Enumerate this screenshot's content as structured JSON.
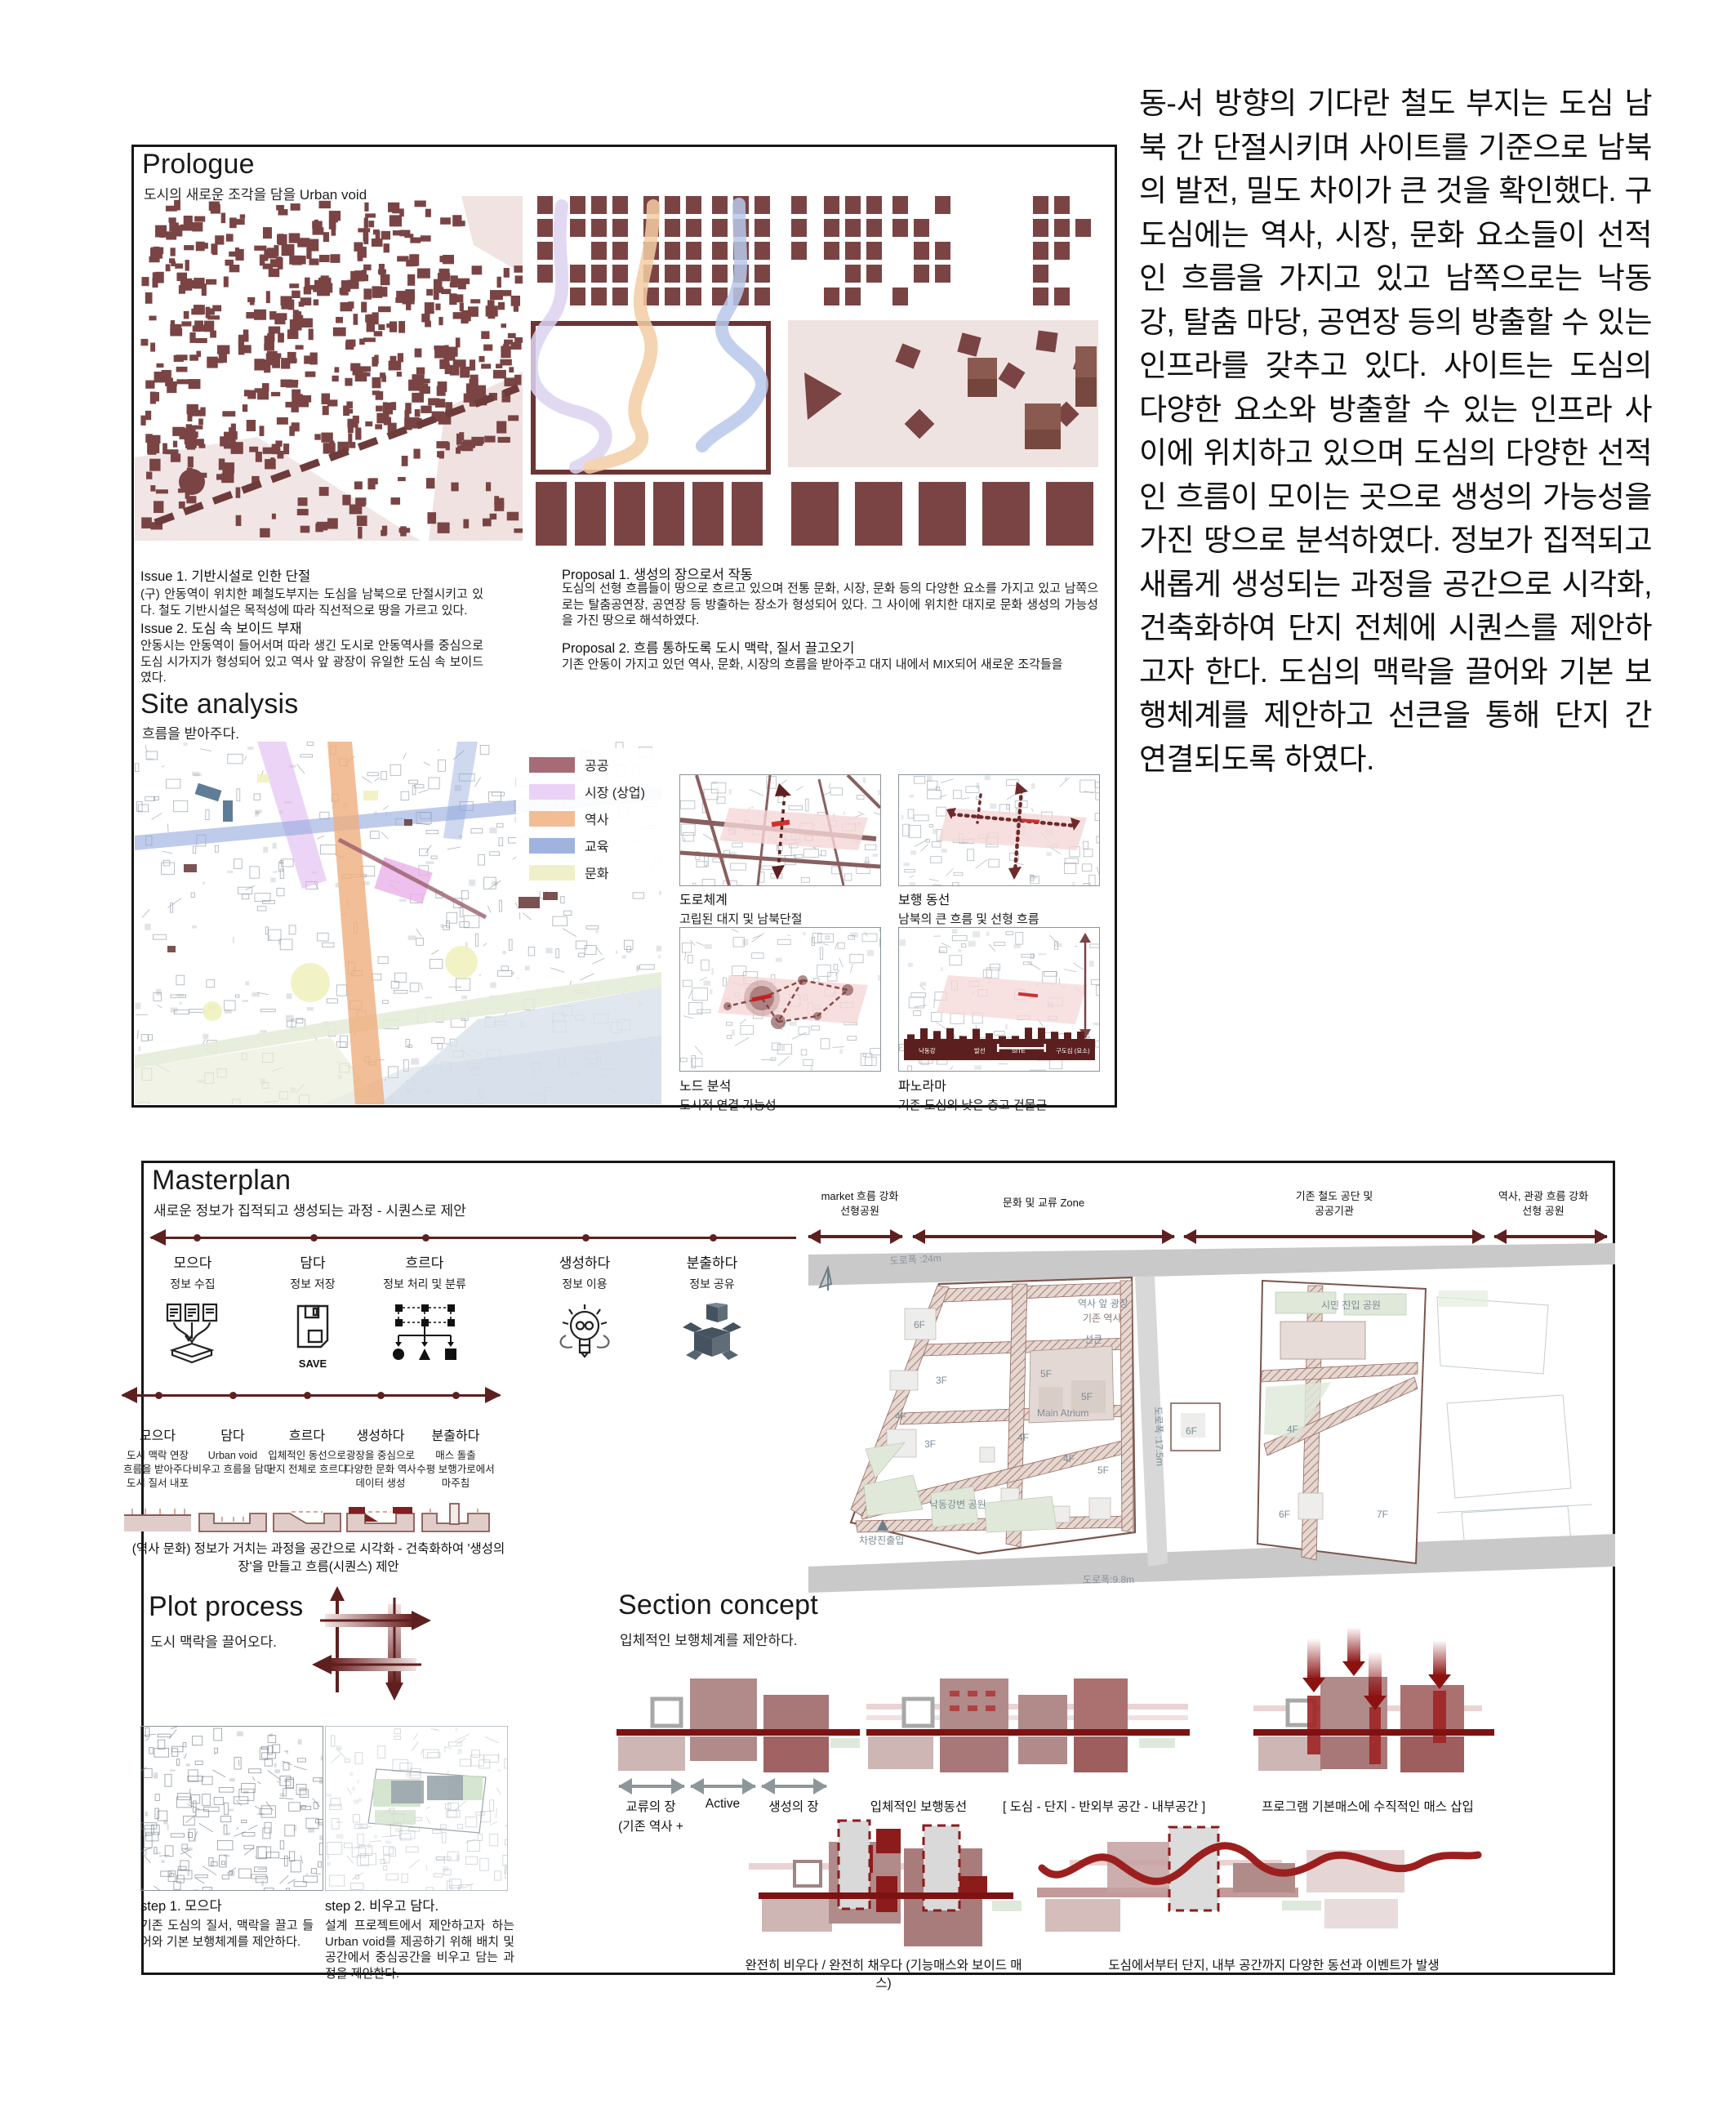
{
  "prologue": {
    "title": "Prologue",
    "subtitle": "도시의 새로운 조각을 담을 Urban void",
    "issue1_title": "Issue 1. 기반시설로 인한 단절",
    "issue1_body": "(구) 안동역이 위치한 폐철도부지는 도심을 남북으로 단절시키고 있다. 철도 기반시설은 목적성에 따라 직선적으로 땅을 가르고 있다.",
    "issue2_title": "Issue 2. 도심 속 보이드 부재",
    "issue2_body": "안동시는 안동역이 들어서며 따라 생긴 도시로 안동역사를 중심으로 도심 시가지가 형성되어 있고 역사 앞 광장이 유일한 도심 속 보이드였다.",
    "proposal1_title": "Proposal 1. 생성의 장으로서 작동",
    "proposal1_body": "도심의 선형 흐름들이 땅으로 흐르고 있으며 전통 문화, 시장, 문화 등의 다양한 요소를 가지고 있고 남쪽으로는 탈춤공연장, 공연장 등 방출하는 장소가 형성되어 있다. 그 사이에 위치한 대지로 문화 생성의 가능성을 가진 땅으로 해석하였다.",
    "proposal2_title": "Proposal 2. 흐름 통하도록 도시 맥락, 질서 끌고오기",
    "proposal2_body": "기존 안동이 가지고 있던 역사, 문화, 시장의 흐름을 받아주고 대지 내에서 MIX되어 새로운 조각들을"
  },
  "intro_paragraph": "동-서 방향의 기다란 철도 부지는 도심 남북 간 단절시키며 사이트를 기준으로 남북의 발전, 밀도 차이가 큰 것을 확인했다. 구도심에는 역사, 시장, 문화 요소들이 선적인 흐름을 가지고 있고 남쪽으로는 낙동강, 탈춤 마당, 공연장 등의 방출할 수 있는 인프라를 갖추고 있다. 사이트는 도심의 다양한 요소와 방출할 수 있는 인프라 사이에 위치하고 있으며 도심의 다양한 선적인 흐름이 모이는 곳으로 생성의 가능성을 가진 땅으로 분석하였다. 정보가 집적되고 새롭게 생성되는 과정을 공간으로 시각화, 건축화하여 단지 전체에 시퀀스를 제안하고자 한다. 도심의 맥락을 끌어와 기본 보행체계를 제안하고 선큰을 통해 단지 간 연결되도록 하였다.",
  "site_analysis": {
    "title": "Site analysis",
    "subtitle": "흐름을 받아주다.",
    "legend": [
      {
        "label": "공공",
        "color": "#a56b77"
      },
      {
        "label": "시장 (상업)",
        "color": "#e9d2f6"
      },
      {
        "label": "역사",
        "color": "#f2bd93"
      },
      {
        "label": "교육",
        "color": "#9fb3de"
      },
      {
        "label": "문화",
        "color": "#eff0c8"
      }
    ],
    "maps": [
      {
        "title": "도로체계",
        "caption": "고립된 대지 및 남북단절"
      },
      {
        "title": "보행 동선",
        "caption": "남북의 큰 흐름 및 선형 흐름"
      },
      {
        "title": "노드 분석",
        "caption": "도시적 연결 가능성"
      },
      {
        "title": "파노라마",
        "caption": "기존 도심의 낮은 층고 건물군"
      }
    ],
    "panorama_labels": [
      "낙동강",
      "발선",
      "SITE",
      "구도심 (요소)"
    ]
  },
  "masterplan": {
    "title": "Masterplan",
    "subtitle": "새로운 정보가 집적되고 생성되는 과정 - 시퀀스로 제안",
    "info_steps": [
      {
        "title": "모으다",
        "desc": "정보 수집"
      },
      {
        "title": "담다",
        "desc": "정보 저장"
      },
      {
        "title": "흐르다",
        "desc": "정보 처리 및 분류"
      },
      {
        "title": "생성하다",
        "desc": "정보 이용"
      },
      {
        "title": "분출하다",
        "desc": "정보 공유"
      }
    ],
    "save_label": "SAVE",
    "space_steps": [
      {
        "title": "모으다",
        "desc": "도시 맥락 연장\n흐름을 받아주다\n도시 질서 내포"
      },
      {
        "title": "담다",
        "desc": "Urban void\n비우고 흐름을 담다"
      },
      {
        "title": "흐르다",
        "desc": "입체적인 동선으로\n단지 전체로 흐르다"
      },
      {
        "title": "생성하다",
        "desc": "광장을 중심으로\n다양한 문화 역사\n데이터 생성"
      },
      {
        "title": "분출하다",
        "desc": "매스 돌출\n수평 보행가로에서\n마주침"
      }
    ],
    "sequence_caption": "(역사 문화) 정보가 거치는 과정을 공간으로 시각화 - 건축화하여 '생성의 장'을 만들고 흐름(시퀀스) 제안",
    "zones": [
      "market 흐름 강화\n선형공원",
      "문화 및 교류 Zone",
      "기존 철도 공단 및\n공공기관",
      "역사, 관광 흐름 강화\n선형 공원"
    ],
    "map_labels": {
      "road24": "도로폭 :24m",
      "f6_nw": "6F",
      "plaza": "역사 앞 광장",
      "station": "기존 역사",
      "sunken": "선큰",
      "f3_a": "3F",
      "f5_main": "5F",
      "f5_b": "5F",
      "atrium": "Main Atrium",
      "f3_b": "3F",
      "f4_a": "4F",
      "f4_b": "4F",
      "f4_c": "4F",
      "f5_c": "5F",
      "f5_d": "5F",
      "river_park": "낙동강변 공원",
      "vehicle": "차량진출입",
      "road98": "도로폭:9.8m",
      "road175": "도로폭 :17.5m",
      "citizen_park": "시민 진입 공원",
      "f6_mid": "6F",
      "f4_d": "4F",
      "f6_b": "6F",
      "f7": "7F"
    }
  },
  "plot_process": {
    "title": "Plot process",
    "subtitle": "도시 맥락을 끌어오다.",
    "step1_title": "step 1.  모으다",
    "step1_body": "기존 도심의 질서, 맥락을 끌고 들어와 기본 보행체계를 제안하다.",
    "step2_title": "step 2. 비우고 담다.",
    "step2_body": "설계 프로젝트에서 제안하고자 하는 Urban void를 제공하기 위해 배치 및 공간에서 중심공간을 비우고 담는 과정을 제안한다."
  },
  "section_concept": {
    "title": "Section concept",
    "subtitle": "입체적인 보행체계를 제안하다.",
    "label_exchange": "교류의 장",
    "label_exchange_sub": "(기존 역사 +",
    "label_active": "Active",
    "label_generation": "생성의 장",
    "label_pedestrian": "입체적인 보행동선",
    "label_hierarchy": "[ 도심 - 단지 - 반외부 공간 - 내부공간 ]",
    "label_vertical": "프로그램 기본매스에 수직적인 매스 삽입",
    "caption_void": "완전히 비우다 / 완전히 채우다 (기능매스와 보이드 매스)",
    "caption_flow": "도심에서부터 단지, 내부 공간까지 다양한 동선과 이벤트가 발생"
  }
}
